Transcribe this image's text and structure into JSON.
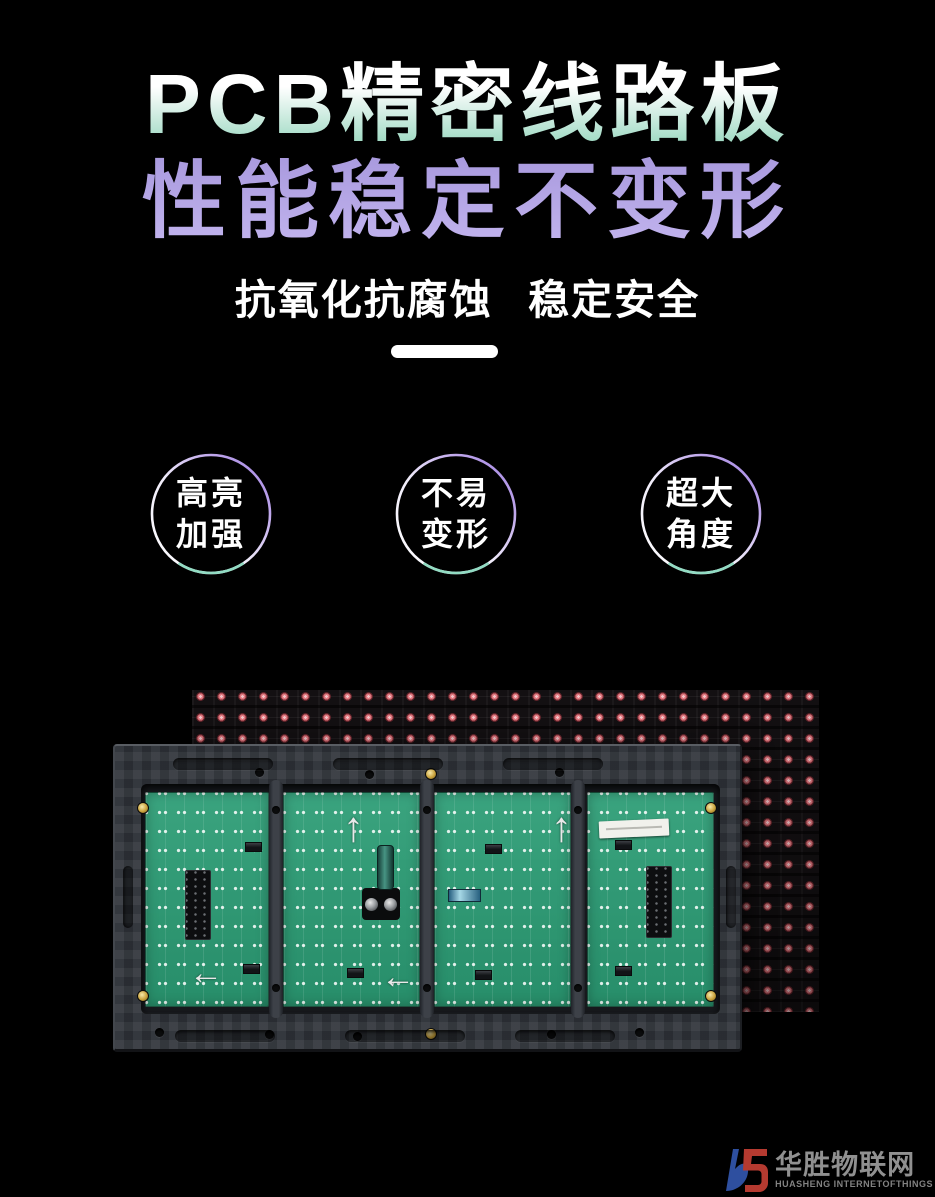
{
  "page": {
    "background_color": "#000000"
  },
  "hero": {
    "title_line1": "PCB精密线路板",
    "title_line2": "性能稳定不变形",
    "subtitle": "抗氧化抗腐蚀 稳定安全",
    "title1_gradient": [
      "#ffffff",
      "#9dd9c2"
    ],
    "title2_gradient": [
      "#a99ade",
      "#c2b4ee"
    ]
  },
  "feature_badges": [
    {
      "line1": "高亮",
      "line2": "加强"
    },
    {
      "line1": "不易",
      "line2": "变形"
    },
    {
      "line1": "超大",
      "line2": "角度"
    }
  ],
  "badge_ring": {
    "white": "#ffffff",
    "purple": "#9d7ee0",
    "teal": "#86d8bc"
  },
  "product": {
    "arrow_up": "↑",
    "arrow_left": "←",
    "led_dot_color": "#ec7d85",
    "pcb_color": "#2b9d75",
    "frame_color": "#2e3238"
  },
  "watermark": {
    "name_cn": "华胜物联网",
    "name_en": "HUASHENG INTERNETOFTHINGS",
    "logo_blue": "#2e4f9f",
    "logo_red": "#b53a30",
    "text_color": "#909090"
  }
}
